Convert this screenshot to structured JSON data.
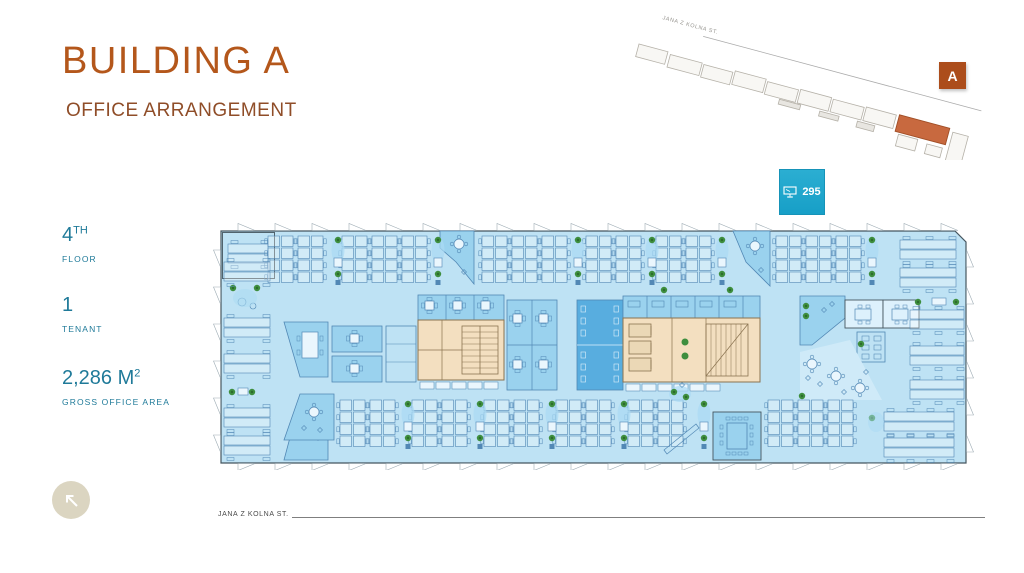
{
  "header": {
    "title": "BUILDING A",
    "subtitle": "OFFICE ARRANGEMENT"
  },
  "stats": [
    {
      "value": "4",
      "sup": "TH",
      "label": "FLOOR"
    },
    {
      "value": "1",
      "sup": "",
      "label": "TENANT"
    },
    {
      "value": "2,286 M",
      "sup": "2",
      "label": "GROSS OFFICE AREA"
    }
  ],
  "workstation_badge": {
    "count": "295",
    "icon": "workstation-icon"
  },
  "site_plan": {
    "street_label": "JANA Z KOLNA ST.",
    "building_label": "A"
  },
  "footer": {
    "street_label": "JANA Z KOLNA ST."
  },
  "colors": {
    "accent_orange": "#B4571B",
    "subtitle_brown": "#8F4D28",
    "stats_teal": "#1F7A99",
    "badge_cyan": "#1EA6CB",
    "site_highlight": "#C8693F",
    "marker_orange": "#AC4D1B",
    "plan": {
      "floor": "#BEE2F4",
      "room_mid": "#9AD2EE",
      "room_dark": "#58ADDF",
      "room_pale": "#DDF1FC",
      "lounge": "#CFEAF8",
      "core": "#F3DFC0",
      "core_fill2": "#EBD8B6",
      "core_line": "#8A7350",
      "wall": "#45565F",
      "furniture": "#5288B5",
      "plant": "#3E8E3E",
      "facade": "#9FADB5",
      "blob": "#A9DAF3",
      "white_fill": "#EAF6FD"
    }
  }
}
